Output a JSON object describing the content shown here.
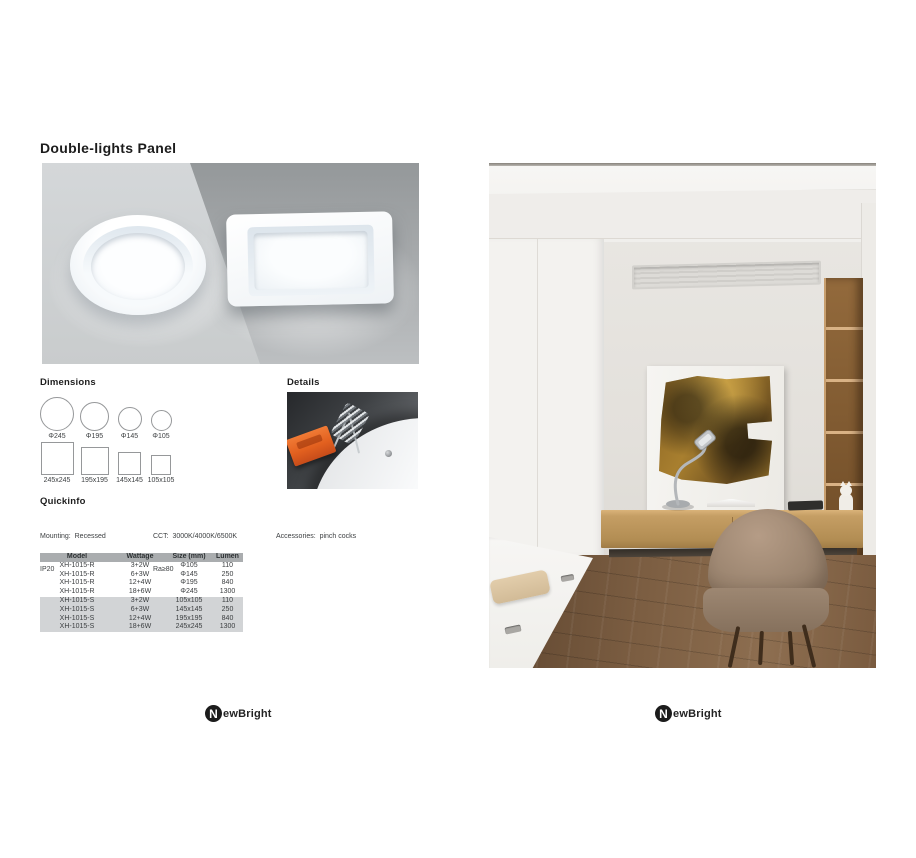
{
  "page": {
    "title": "Double-lights Panel"
  },
  "dimensions": {
    "heading": "Dimensions",
    "round": [
      {
        "label": "Φ245"
      },
      {
        "label": "Φ195"
      },
      {
        "label": "Φ145"
      },
      {
        "label": "Φ105"
      }
    ],
    "square": [
      {
        "label": "245x245"
      },
      {
        "label": "195x195"
      },
      {
        "label": "145x145"
      },
      {
        "label": "105x105"
      }
    ]
  },
  "details": {
    "heading": "Details"
  },
  "quickinfo": {
    "heading": "Quickinfo",
    "left": [
      "Mounting:  Recessed",
      "IP20",
      "Material:  aluminium & plastic"
    ],
    "middle": [
      "CCT:  3000K/4000K/6500K",
      "Ra≥80",
      "Beam Angle:  120°"
    ],
    "right": [
      "Accessories:  pinch cocks"
    ]
  },
  "spec_table": {
    "headers": [
      "Model",
      "Wattage",
      "Size (mm)",
      "Lumen"
    ],
    "rows": [
      [
        "XH-1015-R",
        "3+2W",
        "Φ105",
        "110"
      ],
      [
        "XH-1015-R",
        "6+3W",
        "Φ145",
        "250"
      ],
      [
        "XH-1015-R",
        "12+4W",
        "Φ195",
        "840"
      ],
      [
        "XH-1015-R",
        "18+6W",
        "Φ245",
        "1300"
      ],
      [
        "XH-1015-S",
        "3+2W",
        "105x105",
        "110"
      ],
      [
        "XH-1015-S",
        "6+3W",
        "145x145",
        "250"
      ],
      [
        "XH-1015-S",
        "12+4W",
        "195x195",
        "840"
      ],
      [
        "XH-1015-S",
        "18+6W",
        "245x245",
        "1300"
      ]
    ]
  },
  "footer": {
    "brand_initial": "N",
    "brand_text": "ewBright"
  },
  "colors": {
    "accent_clip_orange": "#e2601f",
    "table_header_bg": "#aaadaf",
    "table_alt_row_bg": "#d2d4d6",
    "hero_bg_light": "#d4d7d9",
    "hero_bg_dark": "#9b9ea0",
    "brand_black": "#1c1c1c"
  }
}
